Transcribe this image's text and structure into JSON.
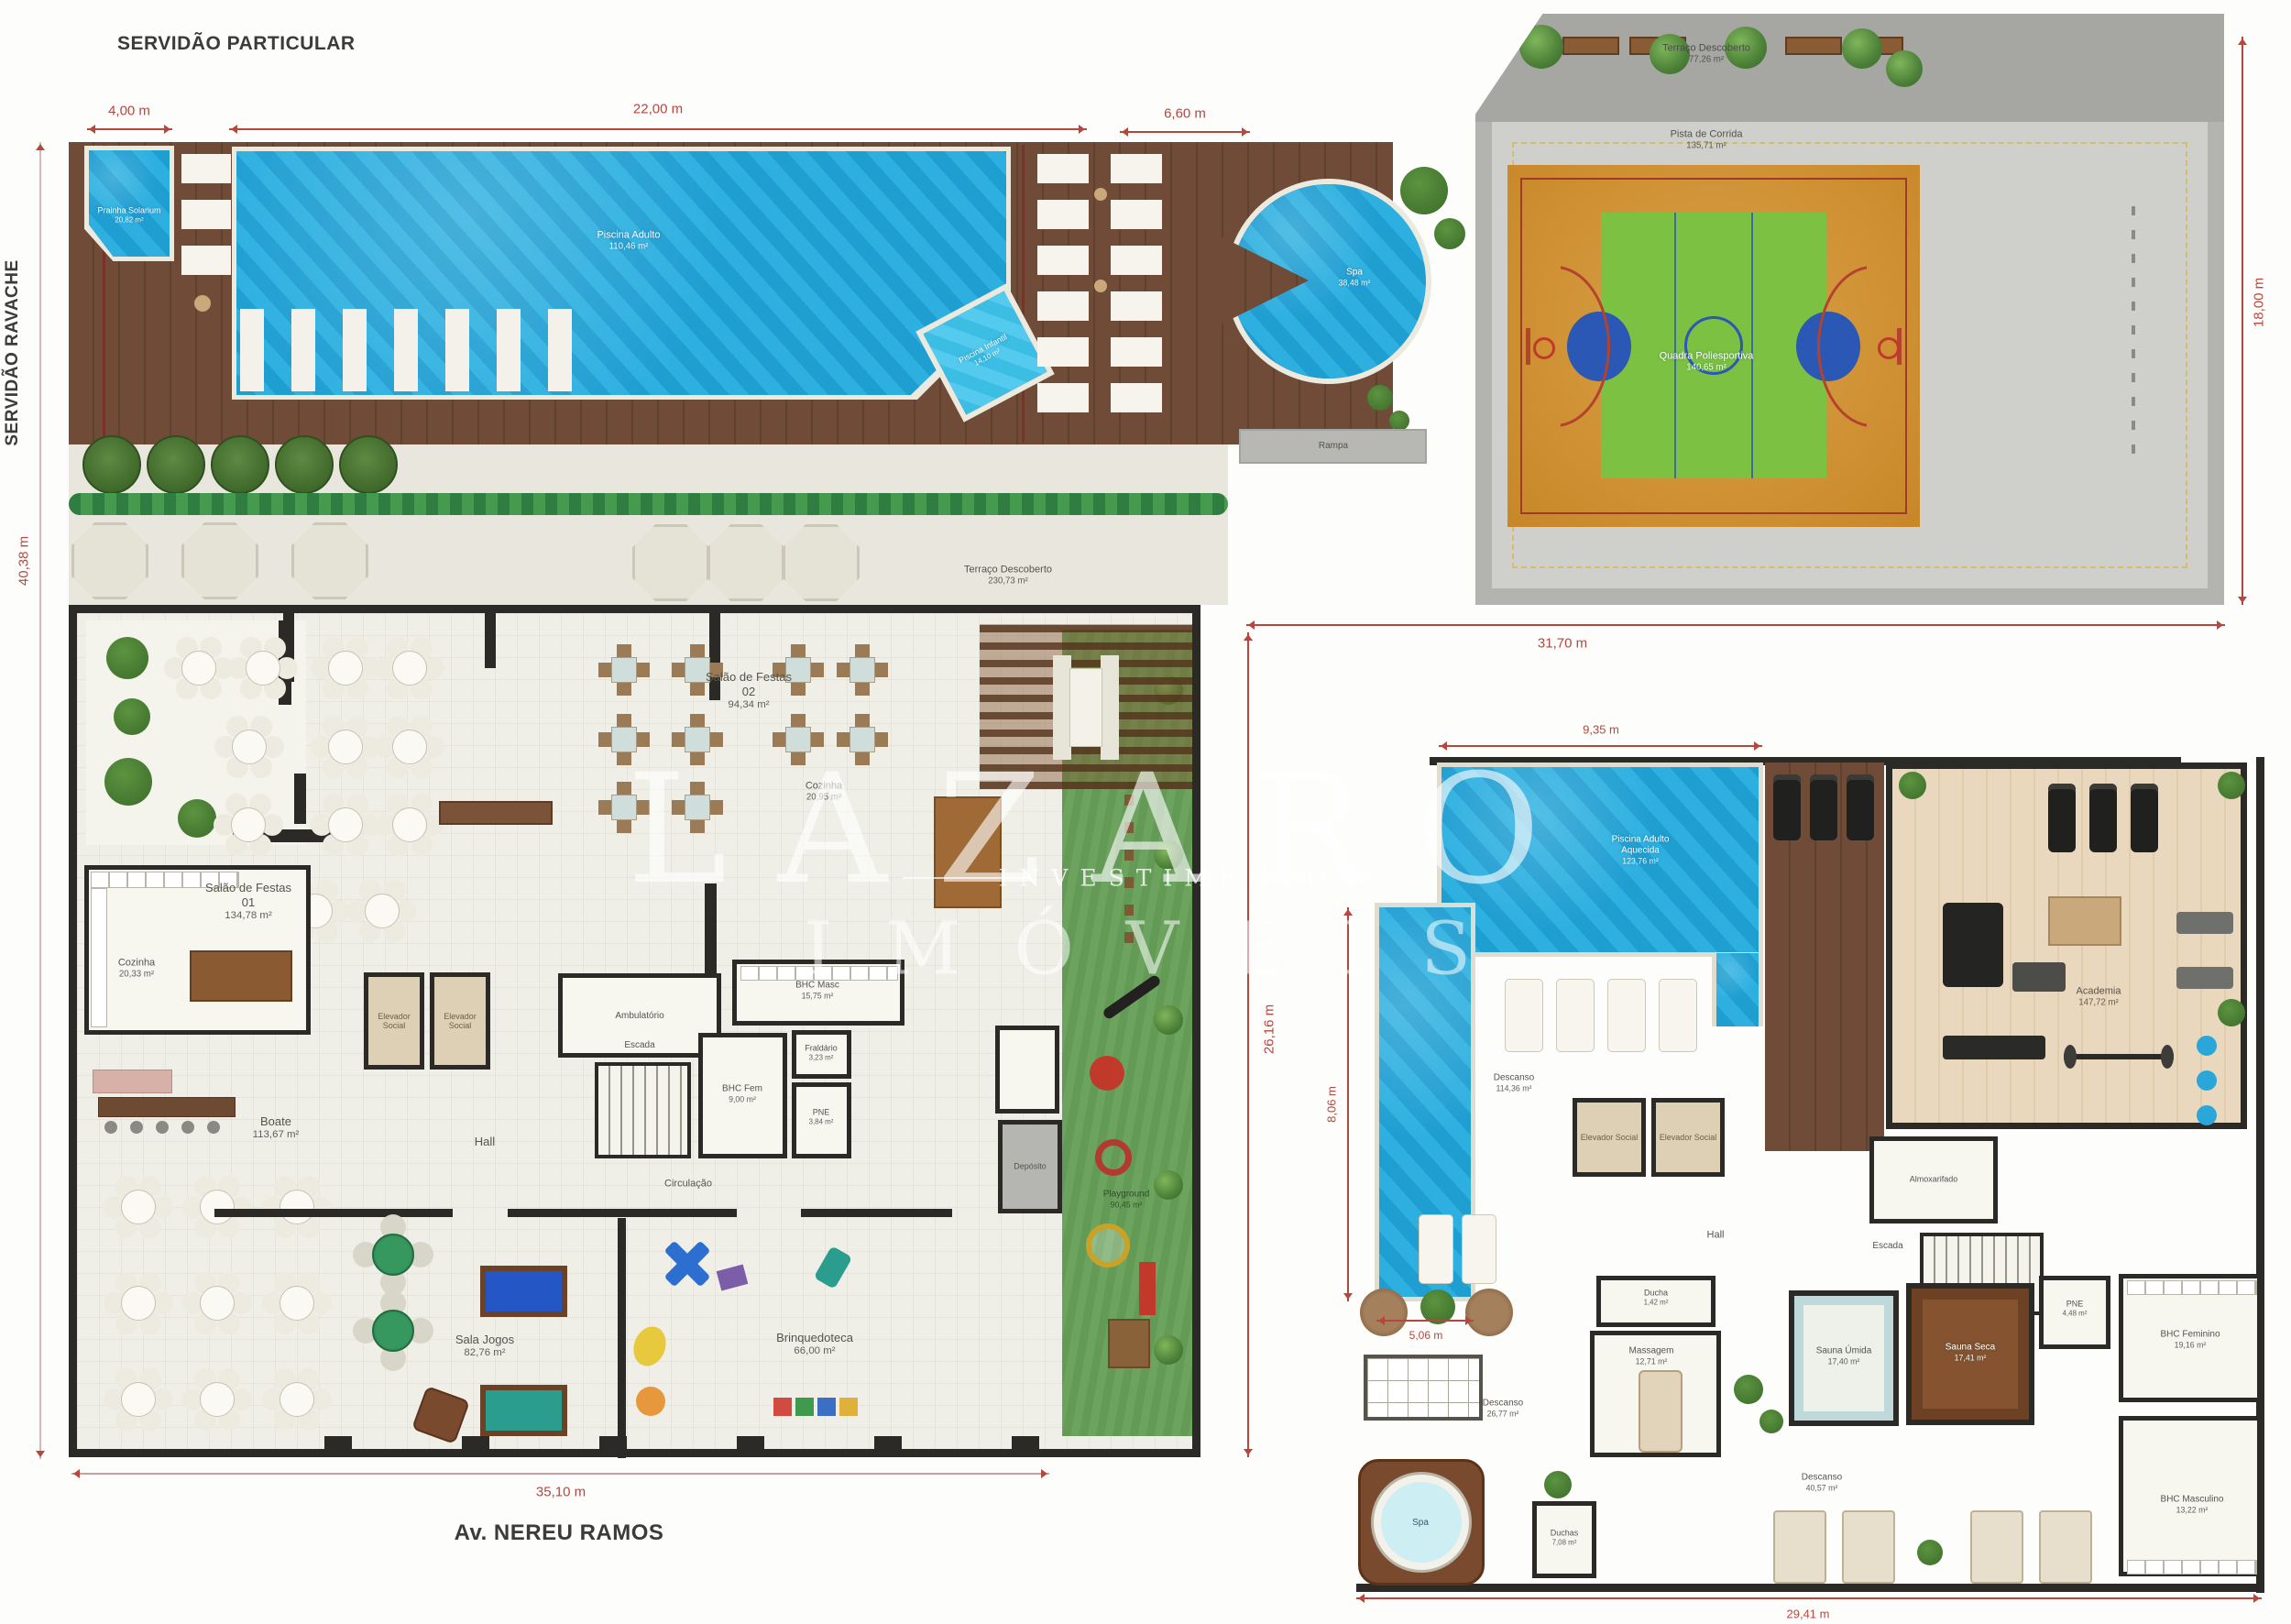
{
  "streets": {
    "top": "SERVIDÃO PARTICULAR",
    "left": "SERVIDÃO RAVACHE",
    "bottom": "Av. NEREU RAMOS"
  },
  "dims": {
    "d1": "4,00 m",
    "d2": "22,00 m",
    "d3": "6,60 m",
    "d4": "40,38 m",
    "d5": "35,10 m",
    "d6": "31,70 m",
    "d7": "18,00 m",
    "d8": "26,16 m",
    "d9": "9,35 m",
    "d10": "8,06 m",
    "d11": "5,06 m",
    "d12": "29,41 m"
  },
  "pool_deck": {
    "prainha": {
      "name": "Prainha Solarium",
      "area": "20,82 m²"
    },
    "piscina_adulto": {
      "name": "Piscina Adulto",
      "area": "110,46 m²"
    },
    "piscina_infantil": {
      "name": "Piscina Infantil",
      "area": "14,10 m²"
    },
    "spa": {
      "name": "Spa",
      "area": "38,48 m²"
    },
    "rampa": {
      "name": "Rampa"
    },
    "terraco": {
      "name": "Terraço Descoberto",
      "area": "230,73 m²"
    }
  },
  "court": {
    "terraco": {
      "name": "Terraço Descoberto",
      "area": "77,26 m²"
    },
    "pista": {
      "name": "Pista de Corrida",
      "area": "135,71 m²"
    },
    "quadra": {
      "name": "Quadra Poliesportiva",
      "area": "140,65 m²"
    }
  },
  "ground_floor": {
    "salao1": {
      "name": "Salão de Festas 01",
      "area": "134,78 m²"
    },
    "salao2": {
      "name": "Salão de Festas 02",
      "area": "94,34 m²"
    },
    "cozinha1": {
      "name": "Cozinha",
      "area": "20,33 m²"
    },
    "cozinha2": {
      "name": "Cozinha",
      "area": "20,95 m²"
    },
    "boate": {
      "name": "Boate",
      "area": "113,67 m²"
    },
    "elevador": {
      "name": "Elevador Social"
    },
    "hall": {
      "name": "Hall"
    },
    "escada": {
      "name": "Escada"
    },
    "ambulatorio": {
      "name": "Ambulatório"
    },
    "bhc_masc": {
      "name": "BHC Masc",
      "area": "15,75 m²"
    },
    "bhc_fem": {
      "name": "BHC Fem",
      "area": "9,00 m²"
    },
    "fraldario": {
      "name": "Fraldário",
      "area": "3,23 m²"
    },
    "pne": {
      "name": "PNE",
      "area": "3,84 m²"
    },
    "circulacao": {
      "name": "Circulação"
    },
    "sala_jogos": {
      "name": "Sala Jogos",
      "area": "82,76 m²"
    },
    "brinquedoteca": {
      "name": "Brinquedoteca",
      "area": "66,00 m²"
    },
    "playground": {
      "name": "Playground",
      "area": "90,45 m²"
    },
    "deposito": {
      "name": "Depósito"
    }
  },
  "leisure_floor": {
    "piscina": {
      "name": "Piscina Adulto Aquecida",
      "area": "123,76 m²"
    },
    "descanso1": {
      "name": "Descanso",
      "area": "114,36 m²"
    },
    "academia": {
      "name": "Academia",
      "area": "147,72 m²"
    },
    "elevador": {
      "name": "Elevador Social"
    },
    "hall": {
      "name": "Hall"
    },
    "escada": {
      "name": "Escada"
    },
    "almoxarifado": {
      "name": "Almoxarifado"
    },
    "ducha": {
      "name": "Ducha",
      "area": "1,42 m²"
    },
    "massagem": {
      "name": "Massagem",
      "area": "12,71 m²"
    },
    "descanso2": {
      "name": "Descanso",
      "area": "26,77 m²"
    },
    "duchas": {
      "name": "Duchas",
      "area": "7,08 m²"
    },
    "spa": {
      "name": "Spa"
    },
    "sauna_umida": {
      "name": "Sauna Úmida",
      "area": "17,40 m²"
    },
    "sauna_seca": {
      "name": "Sauna Seca",
      "area": "17,41 m²"
    },
    "pne": {
      "name": "PNE",
      "area": "4,48 m²"
    },
    "bhc_fem": {
      "name": "BHC Feminino",
      "area": "19,16 m²"
    },
    "bhc_masc": {
      "name": "BHC Masculino",
      "area": "13,22 m²"
    },
    "descanso3": {
      "name": "Descanso",
      "area": "40,57 m²"
    }
  },
  "watermark": {
    "brand": "LAZARO",
    "line": "INVESTIMENTOS",
    "line2": "IMÓVEIS"
  },
  "colors": {
    "pool": "#1f9ed2",
    "pool_light": "#45c2e6",
    "deck": "#6f4b38",
    "wall": "#2b2a27",
    "dimension": "#b5473f",
    "lawn": "#6ca45f",
    "court_orange": "#d2953a",
    "court_green": "#7cc142",
    "court_blue": "#2b57b5",
    "stone": "#e9e7dd"
  }
}
